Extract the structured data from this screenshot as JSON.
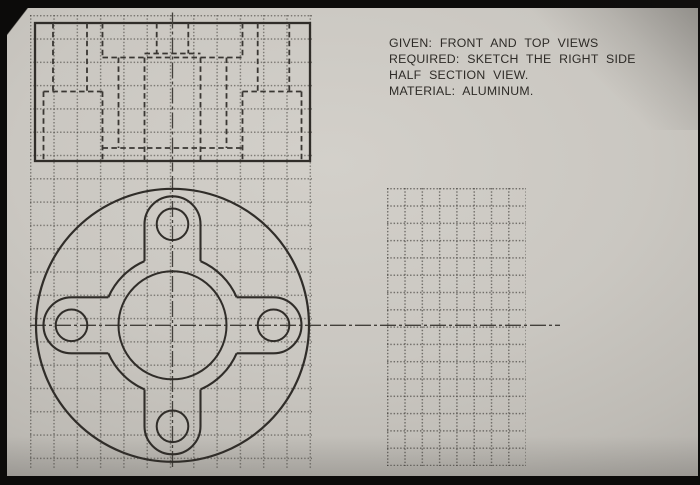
{
  "notes": {
    "lines": [
      "GIVEN: FRONT AND TOP VIEWS",
      "REQUIRED: SKETCH THE RIGHT SIDE",
      "HALF SECTION VIEW.",
      "MATERIAL: ALUMINUM."
    ]
  },
  "style": {
    "solid_line": "#302d29",
    "hidden_line": "#3a3733",
    "center_line": "#43403b",
    "paper_center": "#d3d0ca",
    "paper_edge": "#918e89",
    "border_black": "#0c0b0a"
  },
  "front_view": {
    "rect": {
      "x": 35,
      "y": 23,
      "w": 275,
      "h": 138
    },
    "centerline": {
      "x": 172.5,
      "y1": 12.5,
      "y2": 171.5
    },
    "hidden_v": [
      [
        53,
        23,
        91.5
      ],
      [
        87,
        23,
        91.5
      ],
      [
        257.7,
        23,
        91.5
      ],
      [
        289.3,
        23,
        91.5
      ],
      [
        156.7,
        23,
        53.5
      ],
      [
        188.3,
        23,
        53.5
      ],
      [
        102.5,
        23,
        57.5
      ],
      [
        242.5,
        23,
        57.5
      ],
      [
        102.5,
        91.5,
        160.9
      ],
      [
        242.5,
        91.5,
        160.9
      ],
      [
        118.5,
        57.5,
        148
      ],
      [
        226.5,
        57.5,
        148
      ],
      [
        144.5,
        57.5,
        160.9
      ],
      [
        200.5,
        57.5,
        160.9
      ],
      [
        43.5,
        91.5,
        160.9
      ],
      [
        301.5,
        91.5,
        160.9
      ]
    ],
    "hidden_h": [
      [
        53.5,
        144.5,
        200.5
      ],
      [
        57.5,
        102.5,
        242.5
      ],
      [
        91.5,
        43.5,
        102.5
      ],
      [
        91.5,
        242.5,
        301.5
      ],
      [
        148,
        102.5,
        242.5
      ]
    ]
  },
  "top_view": {
    "cx": 172.5,
    "cy": 325.3,
    "outer_r": 136.5,
    "boss_r": 70,
    "hole_r": 54,
    "lug_offset": 101,
    "lug_hole_r": 15.8,
    "pad_r": 28,
    "centerline_h": {
      "y": 325.3,
      "x1": 30,
      "x2": 560
    },
    "centerline_v": {
      "x": 172.5,
      "y1": 176,
      "y2": 470
    }
  },
  "sketch_area": {
    "x": 387,
    "y": 188,
    "w": 139,
    "h": 278,
    "pitch": 17.3
  },
  "ref_grid": {
    "x": 30,
    "y": 15,
    "w": 282,
    "h": 454,
    "pitch": 23.3
  }
}
